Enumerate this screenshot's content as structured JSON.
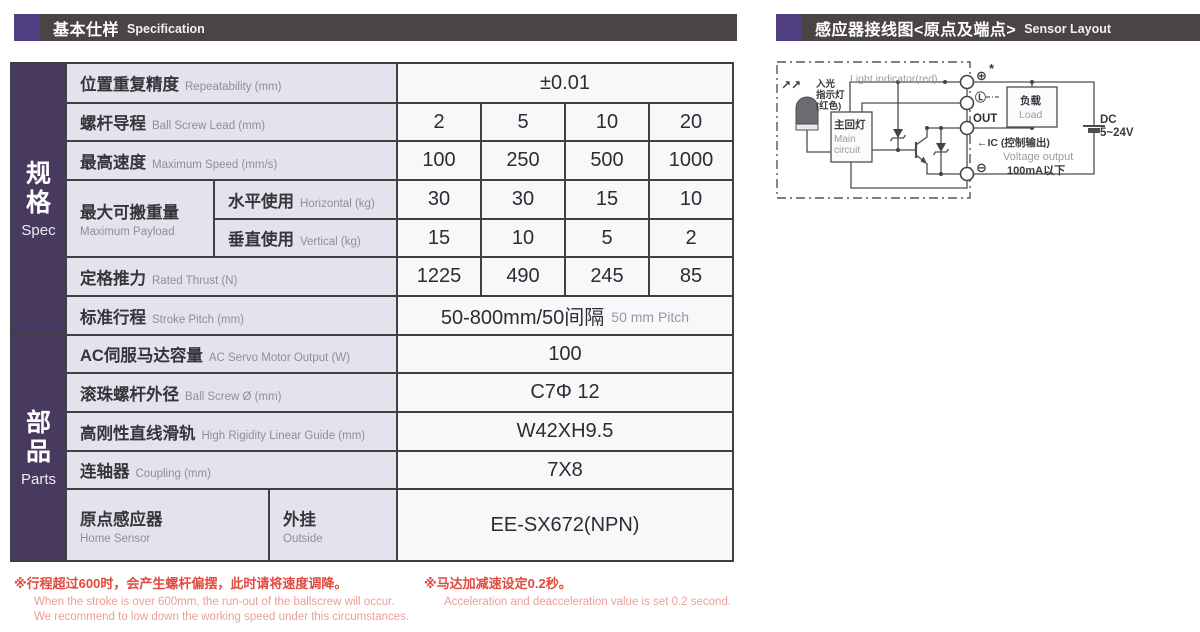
{
  "headers": {
    "left": {
      "cn": "基本仕样",
      "en": "Specification"
    },
    "right": {
      "cn": "感应器接线图<原点及端点>",
      "en": "Sensor Layout"
    }
  },
  "sidebar": {
    "spec": {
      "cn": "规格",
      "en": "Spec"
    },
    "parts": {
      "cn": "部品",
      "en": "Parts"
    }
  },
  "table": {
    "repeatability": {
      "cn": "位置重复精度",
      "en": "Repeatability (mm)",
      "value": "±0.01"
    },
    "lead": {
      "cn": "螺杆导程",
      "en": "Ball Screw Lead (mm)",
      "values": [
        "2",
        "5",
        "10",
        "20"
      ]
    },
    "speed": {
      "cn": "最高速度",
      "en": "Maximum Speed (mm/s)",
      "values": [
        "100",
        "250",
        "500",
        "1000"
      ]
    },
    "payload": {
      "cn": "最大可搬重量",
      "en": "Maximum Payload",
      "horizontal": {
        "cn": "水平使用",
        "en": "Horizontal (kg)",
        "values": [
          "30",
          "30",
          "15",
          "10"
        ]
      },
      "vertical": {
        "cn": "垂直使用",
        "en": "Vertical (kg)",
        "values": [
          "15",
          "10",
          "5",
          "2"
        ]
      }
    },
    "thrust": {
      "cn": "定格推力",
      "en": "Rated Thrust (N)",
      "values": [
        "1225",
        "490",
        "245",
        "85"
      ]
    },
    "stroke": {
      "cn": "标准行程",
      "en": "Stroke Pitch (mm)",
      "value_cn": "50-800mm/50间隔",
      "value_en": "50 mm Pitch"
    },
    "motor": {
      "cn": "AC伺服马达容量",
      "en": "AC Servo Motor Output (W)",
      "value": "100"
    },
    "screw": {
      "cn": "滚珠螺杆外径",
      "en": "Ball Screw Ø (mm)",
      "value": "C7Φ 12"
    },
    "guide": {
      "cn": "高刚性直线滑轨",
      "en": "High Rigidity Linear Guide (mm)",
      "value": "W42XH9.5"
    },
    "coupling": {
      "cn": "连轴器",
      "en": "Coupling (mm)",
      "value": "7X8"
    },
    "home_sensor": {
      "cn": "原点感应器",
      "en": "Home Sensor",
      "outside_cn": "外挂",
      "outside_en": "Outside",
      "value": "EE-SX672(NPN)"
    }
  },
  "notes": {
    "note1": {
      "cn": "※行程超过600时，会产生螺杆偏摆，此时请将速度调降。",
      "en1": "When the stroke is over 600mm, the run-out of the ballscrew will occur.",
      "en2": "We recommend to low down the working speed under this circumstances."
    },
    "note2": {
      "cn": "※马达加减速设定0.2秒。",
      "en": "Acceleration and deacceleration value is set 0.2 second."
    }
  },
  "diagram": {
    "arrows": "↗↗",
    "light_cn1": "入光",
    "light_cn2": "指示灯",
    "light_cn3": "(红色)",
    "light_en": "Light indicator(red)",
    "main_cn": "主回灯",
    "main_en1": "Main",
    "main_en2": "circuit",
    "plus": "⊕",
    "asterisk": "*",
    "l_terminal": "Ⓛ",
    "out": "OUT",
    "minus": "⊖",
    "ic": "←IC (控制输出)",
    "voltage": "Voltage output",
    "current": "100mA以下",
    "load_cn": "负载",
    "load_en": "Load",
    "dc1": "DC",
    "dc2": "5~24V"
  },
  "colors": {
    "accent_purple": "#4f3f82",
    "sidebar_purple": "#483a5f",
    "bar_dark": "#4a4444",
    "note_red": "#e2493f"
  }
}
